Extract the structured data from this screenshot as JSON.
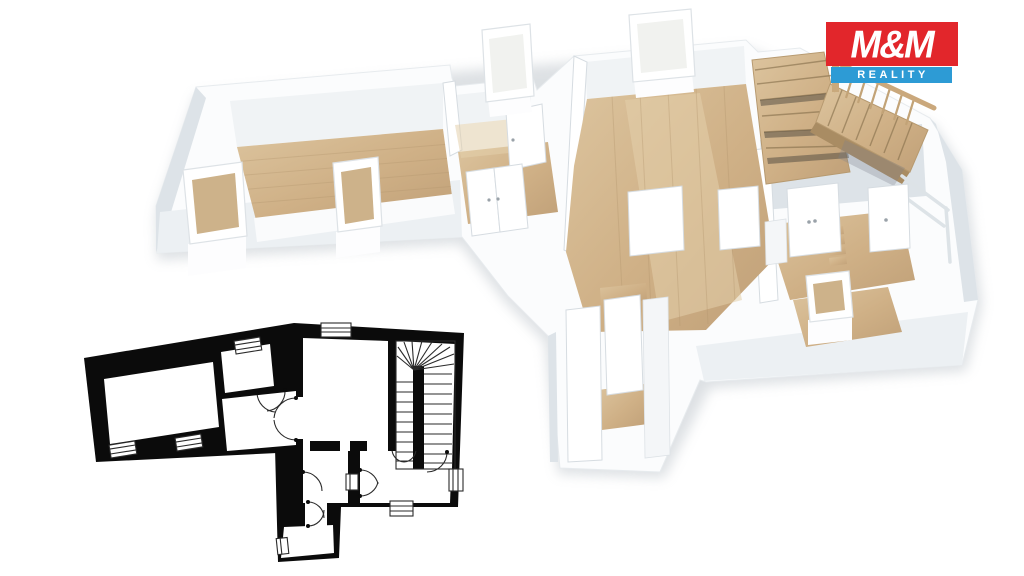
{
  "logo": {
    "title": "M&M",
    "subtitle": "REALITY"
  },
  "colors": {
    "background": "#ffffff",
    "logo-red": "#e2262b",
    "logo-blue": "#2d9bd5",
    "logo-text": "#ffffff",
    "plan-black": "#0b0b0b",
    "plan-room": "#ffffff",
    "plan-line": "#2a2a2a",
    "wall-white": "#fbfcfd",
    "wall-shade": "#ecf0f3",
    "wall-inner": "#f0f3f5",
    "wall-dark": "#dde3e8",
    "wood": "#cfb086",
    "wood-light": "#e3d0ac",
    "wood-dark": "#a98c63",
    "glass": "#f1f2ef",
    "shadow": "#aab3bb"
  }
}
